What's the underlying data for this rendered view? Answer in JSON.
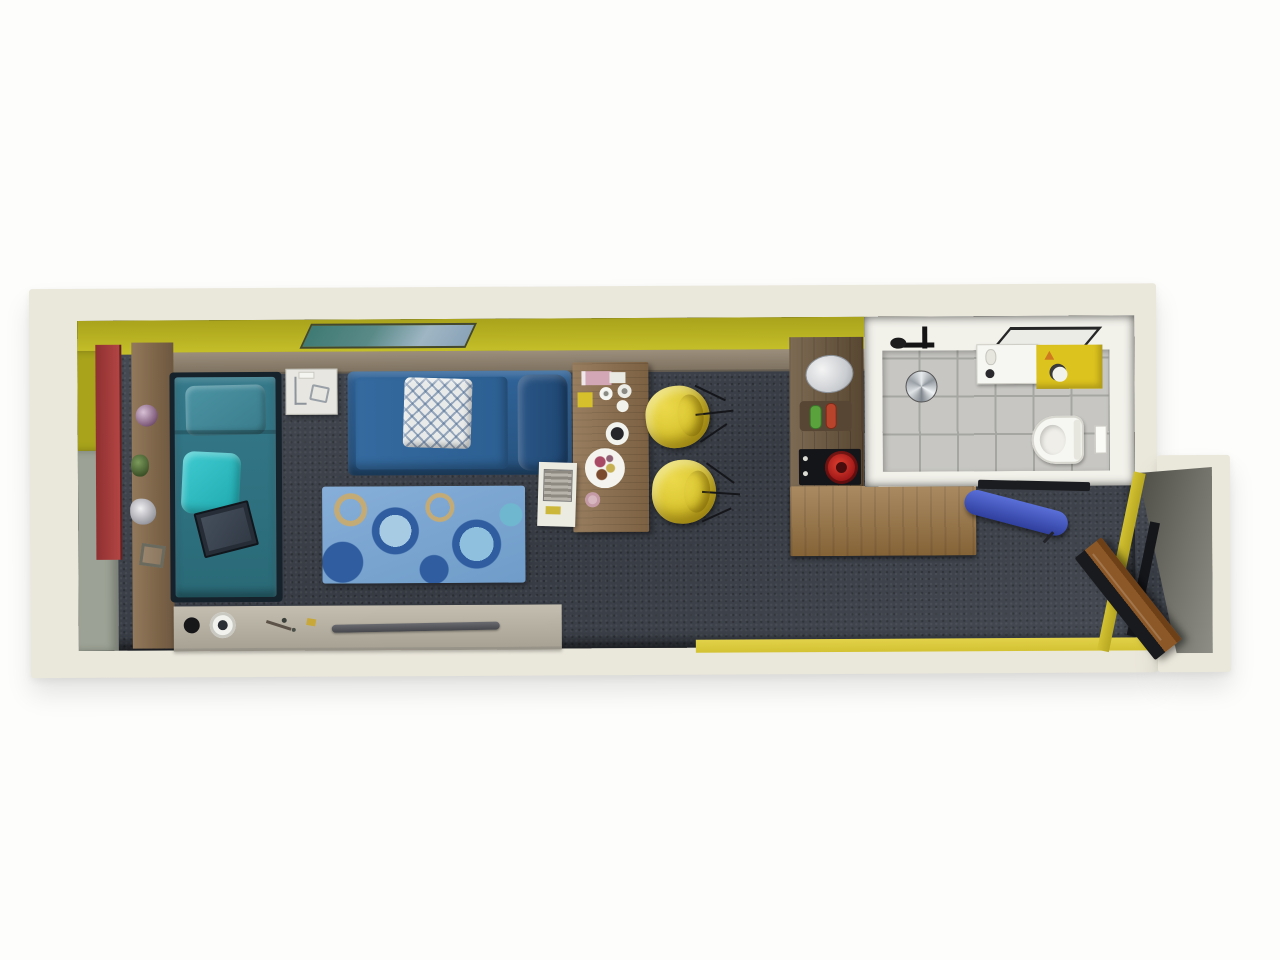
{
  "scene": {
    "type": "3d-floor-plan-top-view",
    "description": "Photorealistic top-down 3D floor plan of a long narrow studio apartment with living area, kitchenette, bathroom and entry"
  },
  "palette": {
    "page_bg": "#fdfdfb",
    "wall_outer": "#eae7db",
    "wall_inner_gray": "#9ca295",
    "wall_yellow": "#c6c02a",
    "wall_yellow_dk": "#a8a31b",
    "floor_yellow": "#d3c232",
    "panel_red": "#b24543",
    "wood_ledge": "#7f7260",
    "wood_ledge_lt": "#9c8f7c",
    "wood_dark": "#6b563c",
    "counter_wood": "#97713f",
    "desk_wood": "#8a6c49",
    "sideboard": "#a8a294",
    "carpet": "#3e434c",
    "bed_frame": "#15212b",
    "bed_teal": "#2a6a77",
    "bed_teal_lt": "#3a7d8c",
    "pillow_cyan": "#1fa9af",
    "sofa_blue": "#27537f",
    "sofa_blue_dk": "#1f4773",
    "pillow_white": "#e8eaea",
    "rug_base": "#7ea9d6",
    "rug_navy": "#2f5d9f",
    "rug_light": "#a8cbe4",
    "rug_tan": "#c4ab76",
    "chair_yellow": "#d9c52f",
    "chair_yellow_dk": "#b89f1a",
    "cooktop": "#141519",
    "pot_red": "#a01818",
    "tile": "#c7c6c2",
    "grout": "#a5a5a1",
    "bath_wall": "#f2f1ea",
    "fixture_white": "#f6f6f2",
    "counter_yellow": "#ddc31e",
    "entry_wall": "#72726a",
    "entry_wall_dk": "#4d4d46",
    "door_wood": "#8d5827",
    "door_dark": "#191a1d",
    "board_blue": "#2f3f9e",
    "paint_frame": "#43482f"
  },
  "objects": {
    "plan": "3D top-down floor plan of a studio apartment",
    "bed": "Single bed with teal bedding",
    "bed_pillow": "Teal head pillow",
    "accent_pillow": "Cyan accent pillow",
    "tablet": "Dark tablet lying on the bed",
    "nightstand": "White nightstand with sketches",
    "sofa": "Blue leather sofa",
    "lattice_pillow": "White lattice-pattern throw pillow",
    "rug": "Blue rug with circle pattern",
    "desk": "Wooden dining table with tableware and food plate",
    "chair": "Yellow shell chair with wire legs",
    "side_tray": "White side table with book",
    "sideboard": "Low gray media sideboard",
    "soundbar": "Slim soundbar",
    "speaker": "Round dial speaker",
    "knob": "Black round speaker knob",
    "painting": "Teal landscape painting leaning on the yellow wall",
    "ledge": "Wooden wall ledge",
    "red_panel": "Red wardrobe door panel",
    "ornaments": "Decorative wall ornaments",
    "kitchen_strip": "Kitchenette wall unit",
    "kettle": "Silver kettle",
    "cutting_board": "Cutting board with oil and vinegar bottles",
    "cooktop": "Black cooktop with red pan",
    "counter": "L-shaped wooden kitchen counter",
    "bathroom": "Tiled bathroom",
    "shower": "Ceiling shower fixture and drain",
    "shower_glass": "Shower glass panel frame",
    "bath_sink": "White washbasin cabinet",
    "bath_counter": "Yellow bathroom counter with soap dish",
    "toilet": "Wall-hung toilet",
    "flush_plate": "Flush plate",
    "entry": "Entry area with charcoal carpet and yellow floor band",
    "entry_wall": "Angled entry wall",
    "door": "Open wooden entrance door",
    "door_frame": "Black door frame",
    "ironing_board": "Blue wall-mounted folding board",
    "rail": "Black wall rail bracket"
  }
}
